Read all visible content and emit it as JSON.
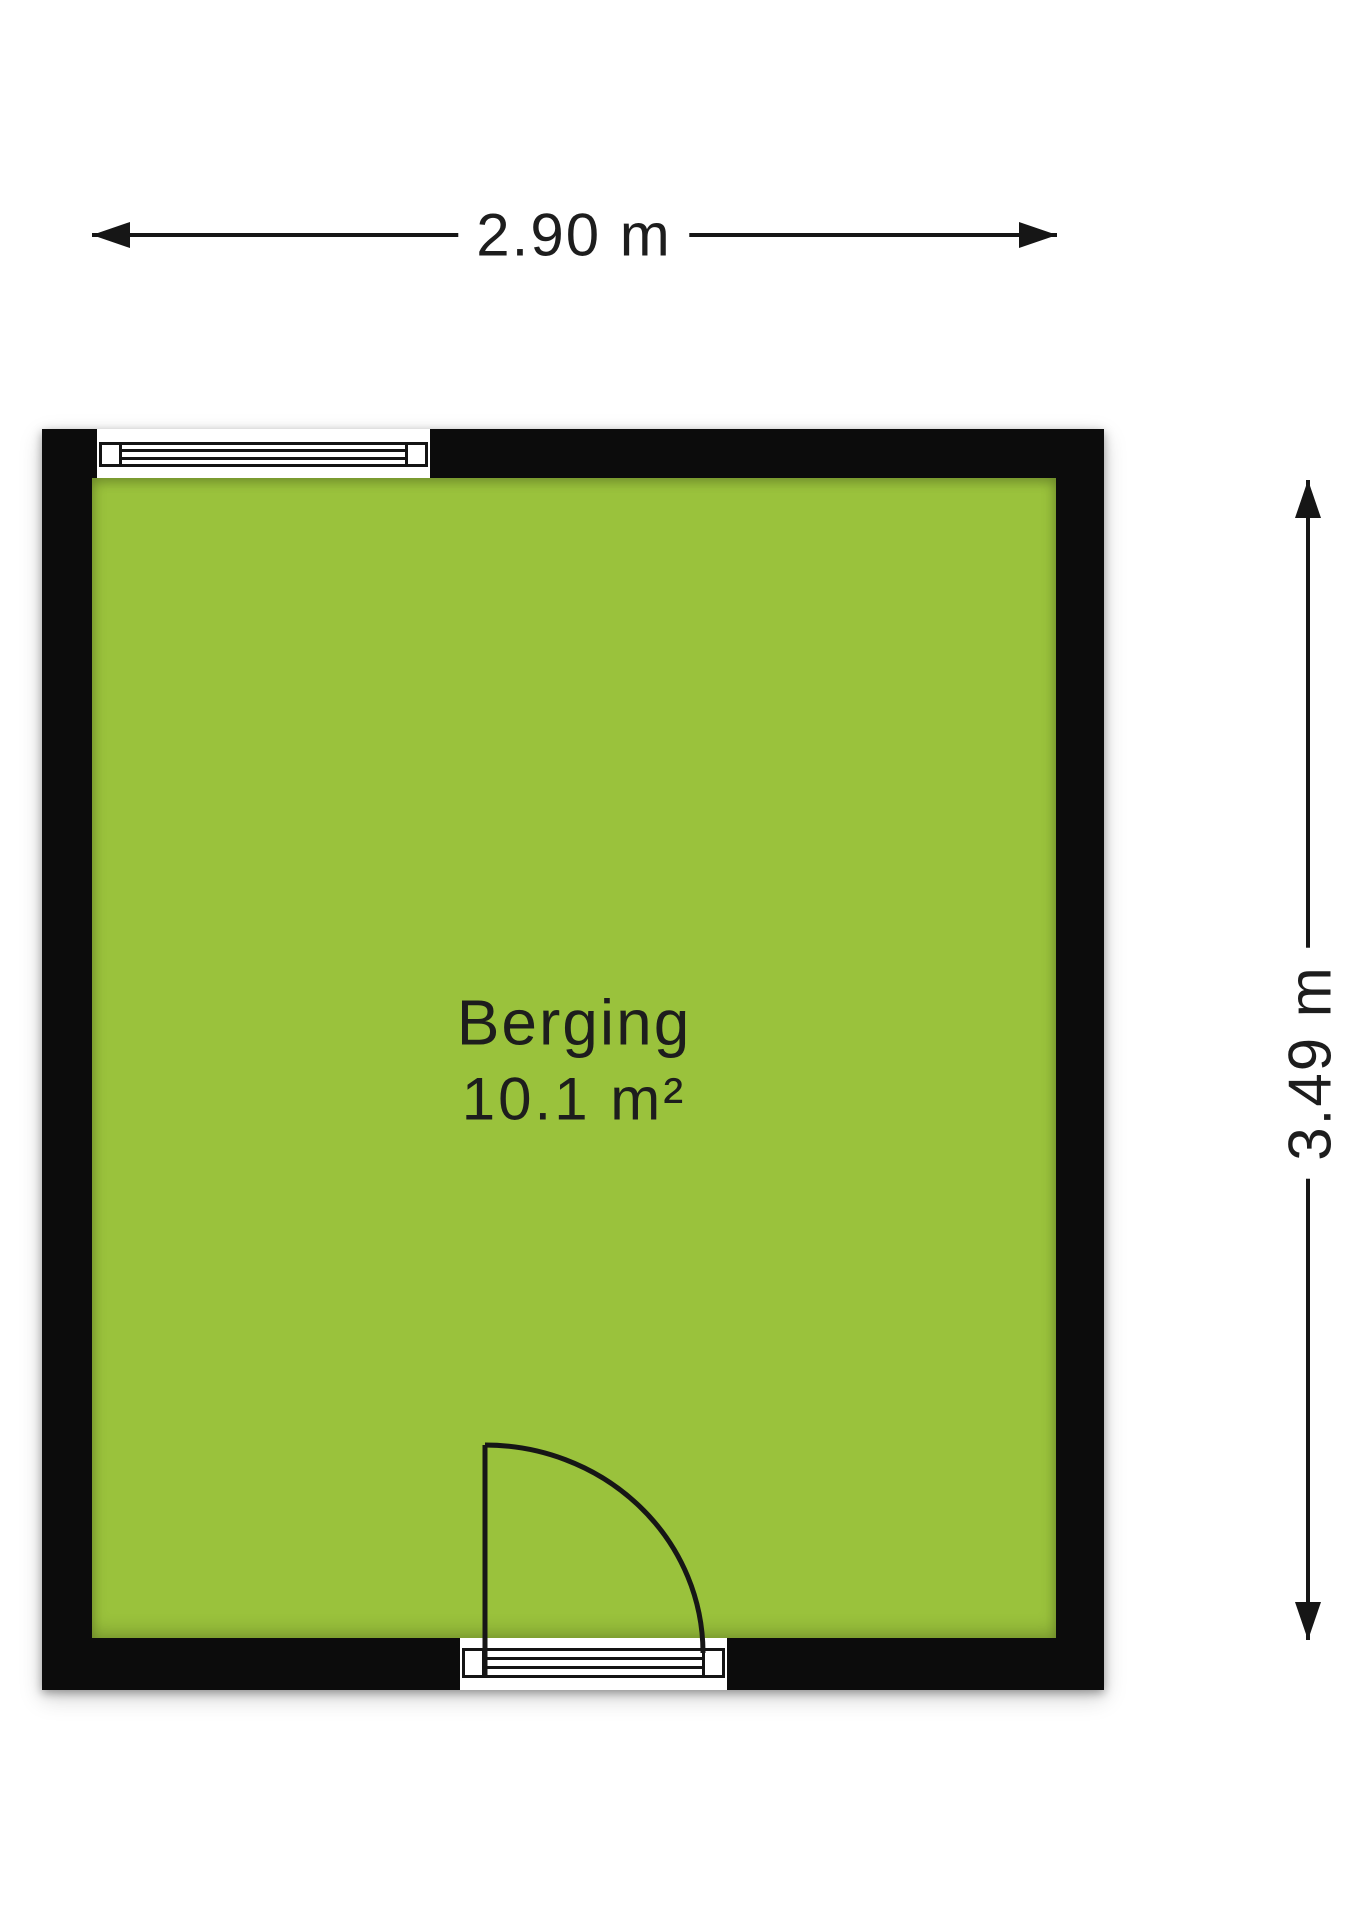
{
  "floorplan": {
    "room": {
      "name": "Berging",
      "area": "10.1 m²"
    },
    "dimensions": {
      "width": "2.90 m",
      "height": "3.49 m"
    },
    "colors": {
      "wall": "#0c0c0c",
      "floor": "#9ac23c",
      "line": "#161616",
      "text": "#1d1d1d",
      "background": "#ffffff"
    },
    "symbols": {
      "window": "window-icon",
      "door": "door-swing-icon"
    }
  }
}
